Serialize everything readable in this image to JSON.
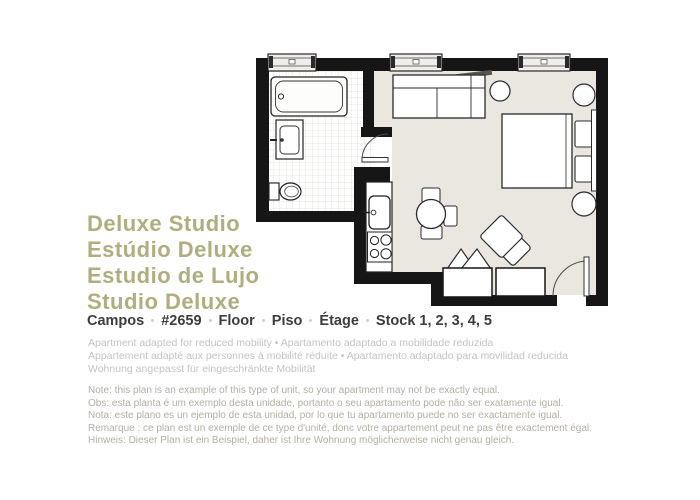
{
  "title_block": {
    "lines": [
      "Deluxe Studio",
      "Estúdio Deluxe",
      "Estudio de Lujo",
      "Studio Deluxe"
    ],
    "color": "#b1ad7e"
  },
  "info_line": {
    "items": [
      "Campos",
      "#2659",
      "Floor",
      "Piso",
      "Étage",
      "Stock 1, 2, 3, 4, 5"
    ],
    "color": "#3d3d3d"
  },
  "mobility_note": {
    "lines": [
      "Apartment adapted for reduced mobility • Apartamento adaptado a mobilidade reduzida",
      "Appartement adapté aux personnes à mobilité réduite • Apartamento adaptado para movilidad reducida",
      "Wohnung angepasst für eingeschränkte Mobilität"
    ],
    "color": "#c3c3c3"
  },
  "plan_note": {
    "lines": [
      "Note: this plan is an example of this type of unit, so your apartment may not be exactly equal.",
      "Obs: esta planta é um exemplo desta unidade, portanto o seu apartamento pode não ser exatamente igual.",
      "Nota: este plano es un ejemplo de esta unidad, por lo que tu apartamento puede no ser exactamente igual.",
      "Remarque : ce plan est un exemple de ce type d'unité, donc votre appartement peut ne pas être exactement égal.",
      "Hinweis: Dieser Plan ist ein Beispiel, daher ist Ihre Wohnung möglicherweise nicht genau gleich."
    ],
    "color": "#b3afa3"
  },
  "floorplan": {
    "wall_color": "#161616",
    "floor_color": "#e9e7e0",
    "bathroom_floor": "white-tiled",
    "features": [
      "bathtub",
      "bathroom-vanity-sink",
      "toilet",
      "bathroom-door",
      "kitchen-counter",
      "kitchen-sink",
      "stove-4-burners",
      "sofa",
      "wall-shelf",
      "round-side-tables",
      "double-bed",
      "pillows",
      "headboard",
      "dining-table",
      "dining-chairs",
      "armchair",
      "luggage-rack",
      "storage-closets",
      "entry-door",
      "windows-3"
    ]
  }
}
